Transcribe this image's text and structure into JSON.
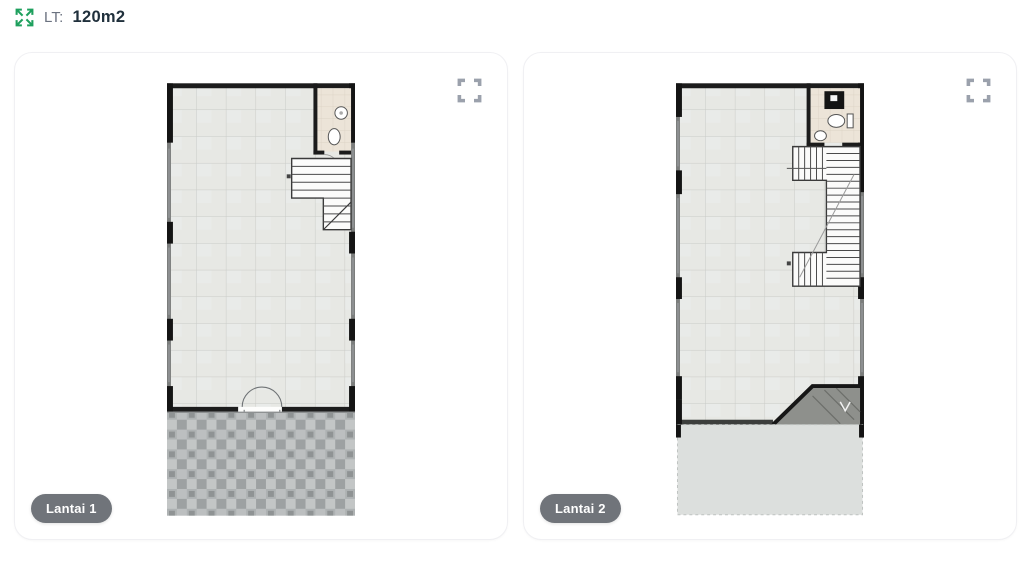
{
  "header": {
    "icon": "expand-arrows-icon",
    "label": "LT:",
    "value": "120m2"
  },
  "cards": [
    {
      "badge": "Lantai 1",
      "plan": "floor-plan-lantai-1",
      "icon": "fullscreen-icon"
    },
    {
      "badge": "Lantai 2",
      "plan": "floor-plan-lantai-2",
      "icon": "fullscreen-icon"
    }
  ],
  "colors": {
    "accent_green": "#1FA05E",
    "label_gray": "#6B7280",
    "value_dark": "#20303C",
    "card_border": "#F0F0F3",
    "icon_gray": "#9BA1AC",
    "badge_bg": "#70747A",
    "badge_text": "#FFFFFF"
  }
}
